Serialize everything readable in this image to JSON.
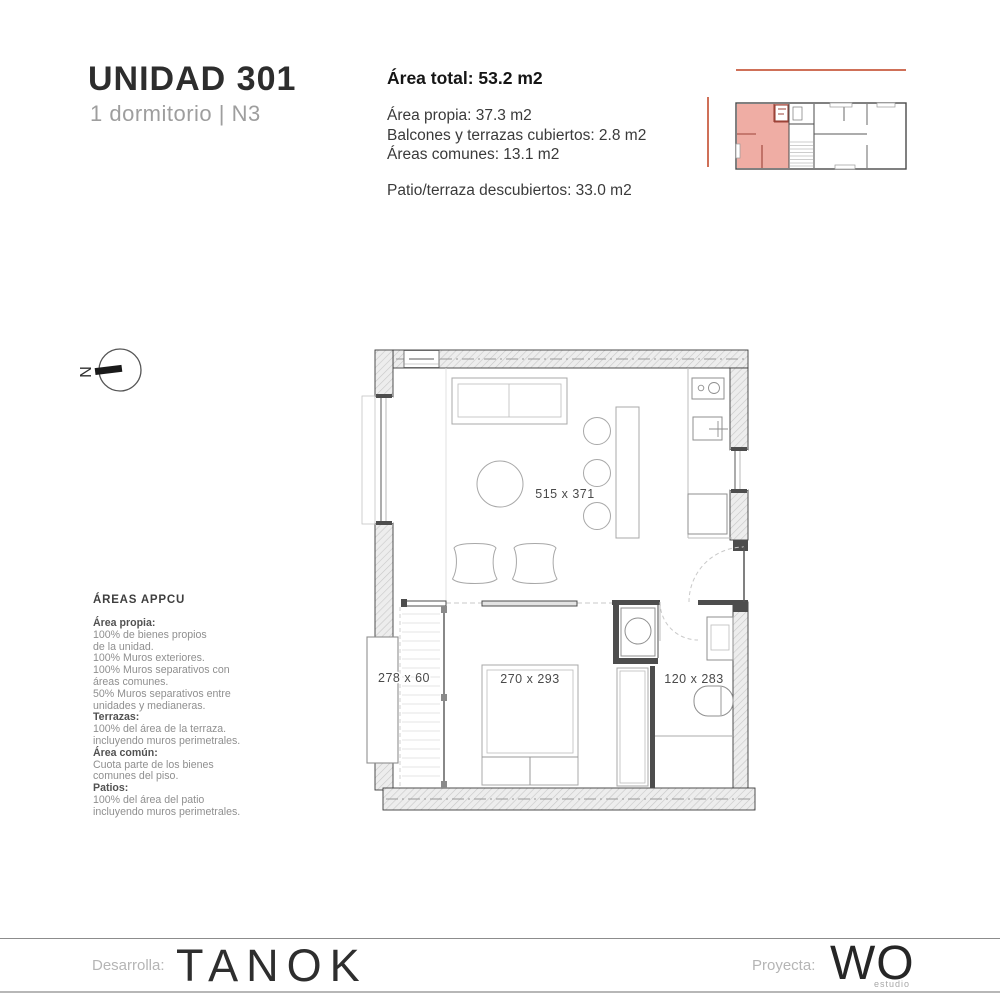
{
  "colors": {
    "accent": "#cf7058",
    "unit_fill": "#efada4",
    "unit_wall": "#9c4338"
  },
  "header": {
    "title": "UNIDAD 301",
    "subtitle": "1 dormitorio | N3"
  },
  "area_summary": {
    "total": "Área total: 53.2 m2",
    "propia": "Área propia: 37.3 m2",
    "balcones": "Balcones y terrazas cubiertos: 2.8 m2",
    "comunes": "Áreas comunes: 13.1 m2",
    "patio": "Patio/terraza descubiertos:  33.0 m2"
  },
  "north": {
    "label": "N"
  },
  "appcu": {
    "title": "ÁREAS APPCU",
    "lines": [
      {
        "t": "Área propia:",
        "b": true
      },
      {
        "t": "100% de bienes propios"
      },
      {
        "t": "de la unidad."
      },
      {
        "t": "100% Muros exteriores."
      },
      {
        "t": "100% Muros separativos con"
      },
      {
        "t": "áreas comunes."
      },
      {
        "t": "50% Muros separativos entre"
      },
      {
        "t": "unidades y medianeras."
      },
      {
        "t": "Terrazas:",
        "b": true
      },
      {
        "t": "100% del área de la terraza."
      },
      {
        "t": "incluyendo muros perimetrales."
      },
      {
        "t": "Área común:",
        "b": true
      },
      {
        "t": "Cuota parte de los bienes"
      },
      {
        "t": "comunes del piso."
      },
      {
        "t": "Patios:",
        "b": true
      },
      {
        "t": "100% del área del patio"
      },
      {
        "t": "incluyendo muros perimetrales."
      }
    ]
  },
  "plan_labels": {
    "living": "515 x 371",
    "bedroom": "270 x 293",
    "bath": "120 x 283",
    "balcony": "278 x 60"
  },
  "footer": {
    "developer_label": "Desarrolla:",
    "developer_name": "TANOK",
    "architect_label": "Proyecta:",
    "architect_name": "WO",
    "architect_tagline": "estudio"
  }
}
